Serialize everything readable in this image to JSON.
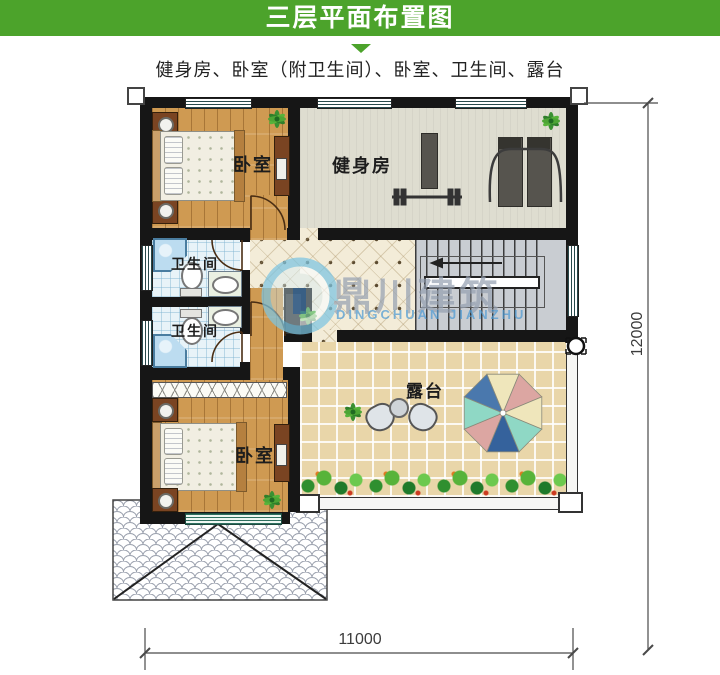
{
  "header": {
    "title": "三层平面布置图"
  },
  "subtitle": "健身房、卧室（附卫生间）、卧室、卫生间、露台",
  "rooms": {
    "bedroom_top": {
      "label": "卧室"
    },
    "gym": {
      "label": "健身房"
    },
    "bathroom_top": {
      "label": "卫生间"
    },
    "bathroom_bottom": {
      "label": "卫生间"
    },
    "bedroom_bottom": {
      "label": "卧室"
    },
    "terrace": {
      "label": "露台"
    }
  },
  "dimensions": {
    "bottom_width": "11000",
    "right_height": "12000"
  },
  "watermark": {
    "name_cn": "鼎川建筑",
    "name_en": "DINGCHUAN JIANZHU"
  },
  "colors": {
    "header_green": "#4CA32B",
    "wall": "#161616",
    "wood_floor": "#cf9a52",
    "gym_floor": "#deddd0",
    "terrace_tile": "#e9d6a9",
    "bath_tile": "#e8f3f8",
    "umbrella": [
      "#efe6bb",
      "#dca6a2",
      "#efe6bb",
      "#8fd8c5",
      "#35629c",
      "#dca6a2",
      "#8fd8c5",
      "#4a78ad"
    ]
  }
}
